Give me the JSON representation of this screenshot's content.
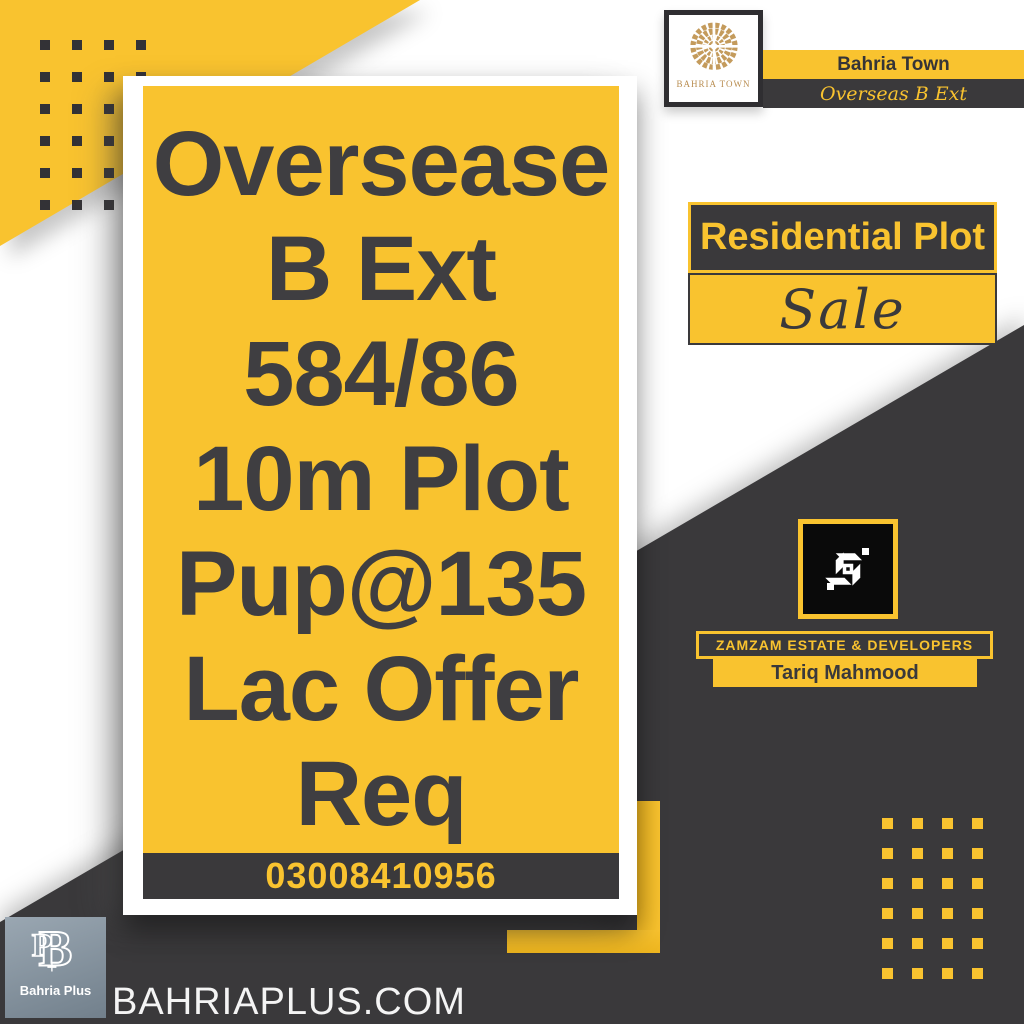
{
  "brand": {
    "logo_caption": "BAHRIA TOWN",
    "name": "Bahria Town",
    "location": "Overseas B Ext"
  },
  "listing": {
    "type": "Residential Plot",
    "deal": "Sale",
    "details_lines": [
      "Oversease",
      "B Ext",
      "584/86",
      "10m Plot",
      "Pup@135",
      "Lac Offer",
      "Req"
    ],
    "phone": "03008410956"
  },
  "agency": {
    "name": "ZAMZAM ESTATE & DEVELOPERS",
    "agent": "Tariq Mahmood"
  },
  "footer": {
    "publisher": "Bahria Plus",
    "website": "BAHRIAPLUS.COM"
  },
  "icons": {
    "brand_logo": "bahria-town-emblem-icon",
    "agency_logo": "zamzam-monogram-icon",
    "publisher_logo": "bahria-plus-monogram-icon"
  },
  "colors": {
    "yellow": "#F9C32F",
    "dark": "#3A393B",
    "gold": "#C49B5C",
    "black": "#0A0A0A",
    "slate": "#8CA0AD",
    "text_dark": "#3F3E41",
    "white": "#FFFFFF"
  }
}
